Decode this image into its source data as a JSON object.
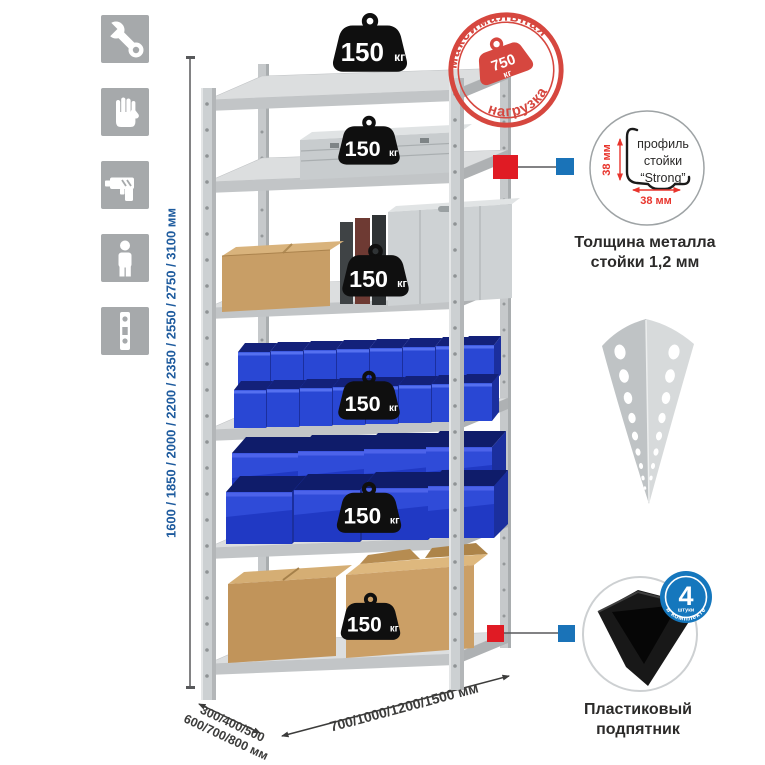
{
  "colors": {
    "accent_red": "#d6473f",
    "marker_red": "#e01b24",
    "accent_blue": "#1a73b8",
    "dim_blue": "#1e5b9e",
    "bin_blue": "#2544cf",
    "text_dark": "#2b2a29"
  },
  "sidebar": {
    "icons": [
      {
        "name": "wrench"
      },
      {
        "name": "gloves"
      },
      {
        "name": "drill"
      },
      {
        "name": "person"
      },
      {
        "name": "level"
      }
    ]
  },
  "rack_dimensions": {
    "height": "1600 / 1850 / 2000 / 2200 / 2350 / 2550 / 2750 / 3100 мм",
    "depth_line1": "300/400/500",
    "depth_line2": "600/700/800 мм",
    "width": "700/1000/1200/1500 мм"
  },
  "shelf_load": {
    "value": "150",
    "unit": "кг"
  },
  "max_load_stamp": {
    "arc_top": "максимальная",
    "arc_bottom": "нагрузка",
    "value": "750",
    "unit": "кг"
  },
  "profile_callout": {
    "text_line1": "профиль",
    "text_line2": "стойки",
    "text_line3": "“Strong”",
    "dim_vertical": "38 мм",
    "dim_horizontal": "38 мм",
    "caption_line1": "Толщина металла",
    "caption_line2": "стойки 1,2 мм"
  },
  "foot_callout": {
    "badge_value": "4",
    "badge_unit": "штуки",
    "badge_arc": "в комплекте",
    "caption_line1": "Пластиковый",
    "caption_line2": "подпятник"
  }
}
